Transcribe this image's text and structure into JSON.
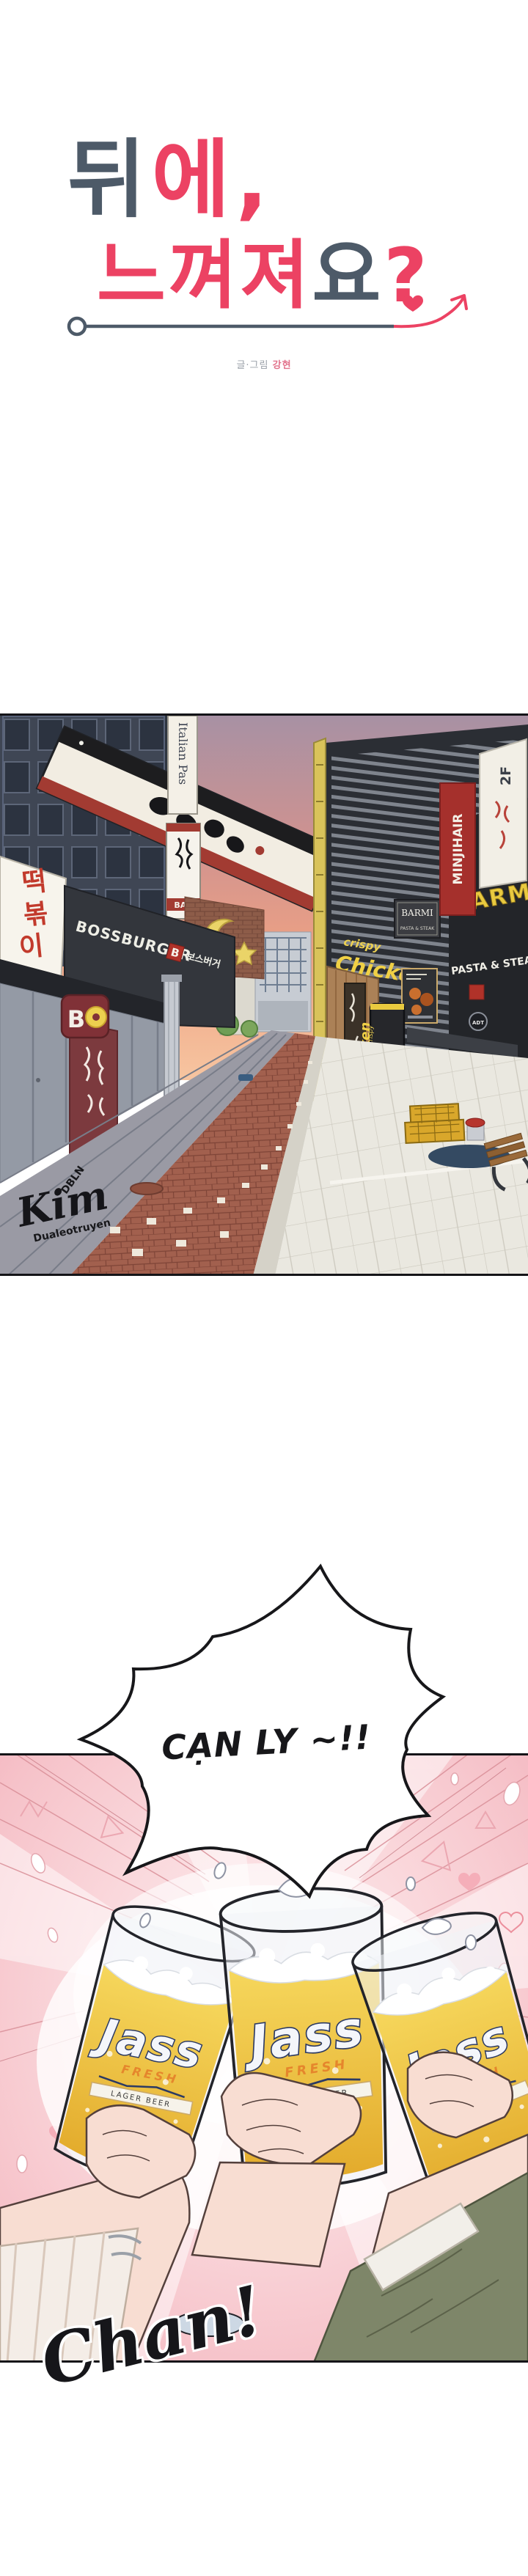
{
  "title": {
    "seg_dark_1": "뒤",
    "seg_pink_1": "에,",
    "seg_pink_2": "느껴져",
    "seg_dark_2": "요",
    "seg_pink_3": "?",
    "credit_label": "글·그림",
    "credit_name": "강현",
    "color_dark": "#4d5a68",
    "color_pink": "#ec4263"
  },
  "street": {
    "sign_italian": "Italian Pas",
    "sign_bar": "BAR",
    "sign_tteok_1": "떡",
    "sign_tteok_2": "볶",
    "sign_tteok_3": "이",
    "sign_bossburger": "BOSSBURGER",
    "sign_boss_b": "B",
    "sign_boss_kr": "보스버거",
    "sign_bo_letter": "B",
    "sign_crispy": "crispy",
    "sign_chicken": "Chicken",
    "sign_minjihair": "MINJIHAIR",
    "sign_2f": "2F",
    "sign_barmi": "BARMI",
    "sign_pasta_steak": "PASTA & STEAK",
    "sign_adt": "ADT",
    "watermark_top": "DBLN",
    "watermark_name": "Kim",
    "watermark_bottom": "Dualeotruyen"
  },
  "toast": {
    "bubble_text": "CẠN LY ~!!",
    "beer_brand": "Jass",
    "beer_fresh": "FRESH",
    "beer_lager": "LAGER BEER",
    "sfx": "Chan!"
  }
}
